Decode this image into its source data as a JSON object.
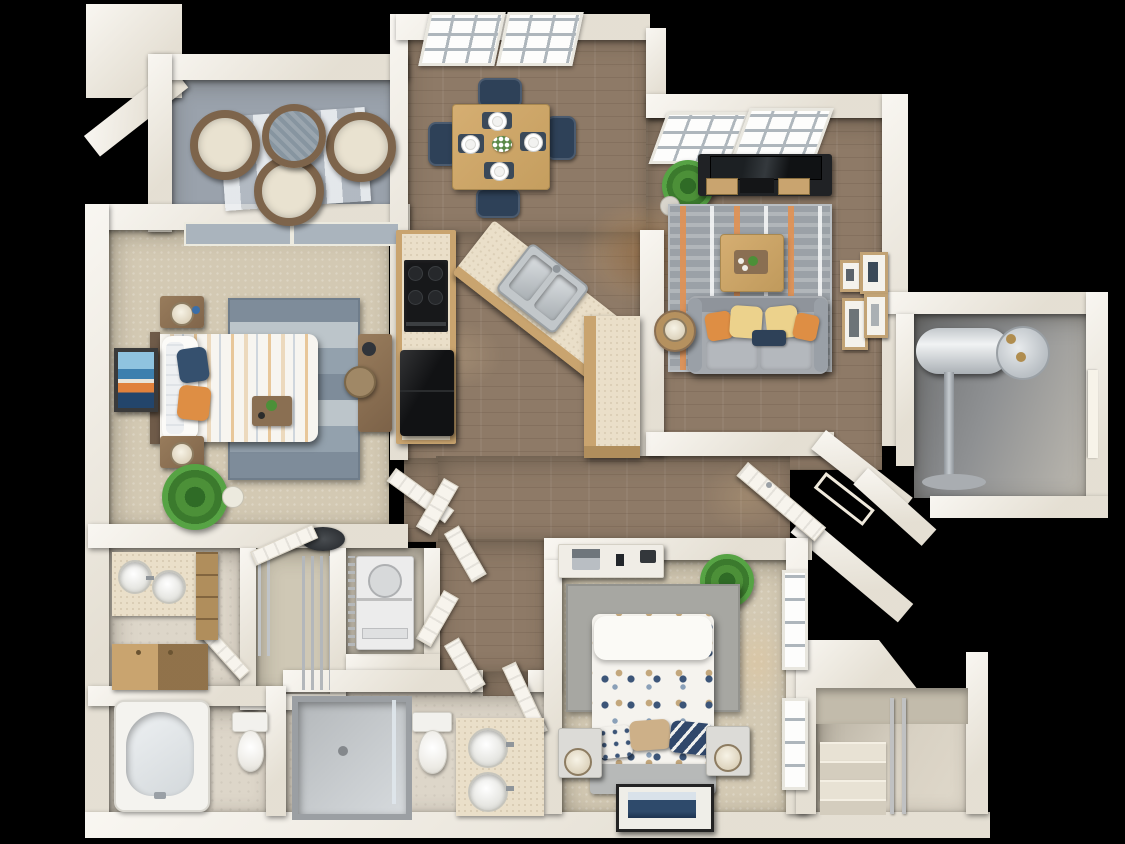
{
  "title": "Two Bedroom / Two Bath Apartment — 3D Floor Plan Rendering",
  "scene": {
    "type": "3d-floorplan-top-down-render",
    "background": "black",
    "text_visible": "none"
  },
  "palette": {
    "bg": "#000000",
    "wall": "#f1ece1",
    "wood": "#8e7a67",
    "carpet": "#d3c9b3",
    "tile": "#ddd6c9",
    "balcony": "#9aa2ac",
    "cabinet": "#c9a46f",
    "cabinetDark": "#b08e5c",
    "counter": "#eadfc9",
    "appliance": "#1a1c1e",
    "sofa": "#a6aaaf",
    "navy": "#2e4158",
    "orange": "#de8e44",
    "yellow": "#ecd28c",
    "plantGreen": "#4c9038",
    "glass": "#aab4bd",
    "steel": "#c6cacc",
    "grayFloor": "#8e9092"
  },
  "rooms": [
    {
      "name": "Balcony",
      "floor": "gray concrete",
      "furniture": [
        "wicker chair",
        "wicker chair",
        "wicker chair",
        "round wicker table",
        "striped outdoor rug"
      ]
    },
    {
      "name": "Dining Area",
      "floor": "hardwood",
      "windows": 2,
      "furniture": [
        "wood dining table",
        "4 navy dining chairs",
        "4 place settings with navy placemats",
        "flower centerpiece"
      ]
    },
    {
      "name": "Living Room",
      "floor": "hardwood",
      "windows": 2,
      "furniture": [
        "tv console with tv",
        "potted plant",
        "striped area rug",
        "wood coffee table with tray",
        "gray sofa",
        "orange and yellow throw pillows",
        "navy lumbar pillow",
        "round side table with lamp",
        "4 wall picture frames"
      ]
    },
    {
      "name": "Kitchen",
      "floor": "hardwood",
      "furniture": [
        "cabinet run with range and cooktop",
        "refrigerator",
        "angled peninsula counter",
        "stainless double sink"
      ]
    },
    {
      "name": "Entry",
      "furniture": [
        "angled open front door"
      ]
    },
    {
      "name": "Hallway",
      "floor": "hardwood",
      "furniture": [
        "bifold closet doors",
        "ceiling light"
      ]
    },
    {
      "name": "Master Bedroom",
      "floor": "carpet",
      "windows": 2,
      "furniture": [
        "bed with striped duvet",
        "navy pillow",
        "orange pillow",
        "2 wood nightstands with lamps",
        "striped blue-gray rug",
        "abstract wall art",
        "desk with chair",
        "potted plant",
        "breakfast tray"
      ]
    },
    {
      "name": "Master Bathroom",
      "furniture": [
        "double round-sink vanity",
        "wood drawer stack",
        "lower wood cabinet"
      ]
    },
    {
      "name": "Walk-in Closet",
      "furniture": [
        "wire shelving",
        "open door"
      ]
    },
    {
      "name": "Laundry Closet",
      "furniture": [
        "stacked washer dryer",
        "wire shelf"
      ]
    },
    {
      "name": "Tub Bathroom",
      "furniture": [
        "bathtub",
        "toilet"
      ]
    },
    {
      "name": "Bathroom 2",
      "furniture": [
        "walk-in shower",
        "toilet",
        "double round-sink vanity"
      ]
    },
    {
      "name": "Bedroom 2",
      "floor": "carpet",
      "windows": 2,
      "furniture": [
        "bed with polka-dot duvet",
        "tan and navy pillows",
        "2 nightstands with drum lamps",
        "white desk with laptop",
        "gray rug",
        "potted plant",
        "framed navy wall art"
      ]
    },
    {
      "name": "Water Heater Closet",
      "floor": "gray",
      "furniture": [
        "cylindrical water heater",
        "supply pipe"
      ]
    },
    {
      "name": "Stairwell",
      "furniture": [
        "carpeted stairs",
        "handrail",
        "sloped roof section"
      ]
    }
  ]
}
